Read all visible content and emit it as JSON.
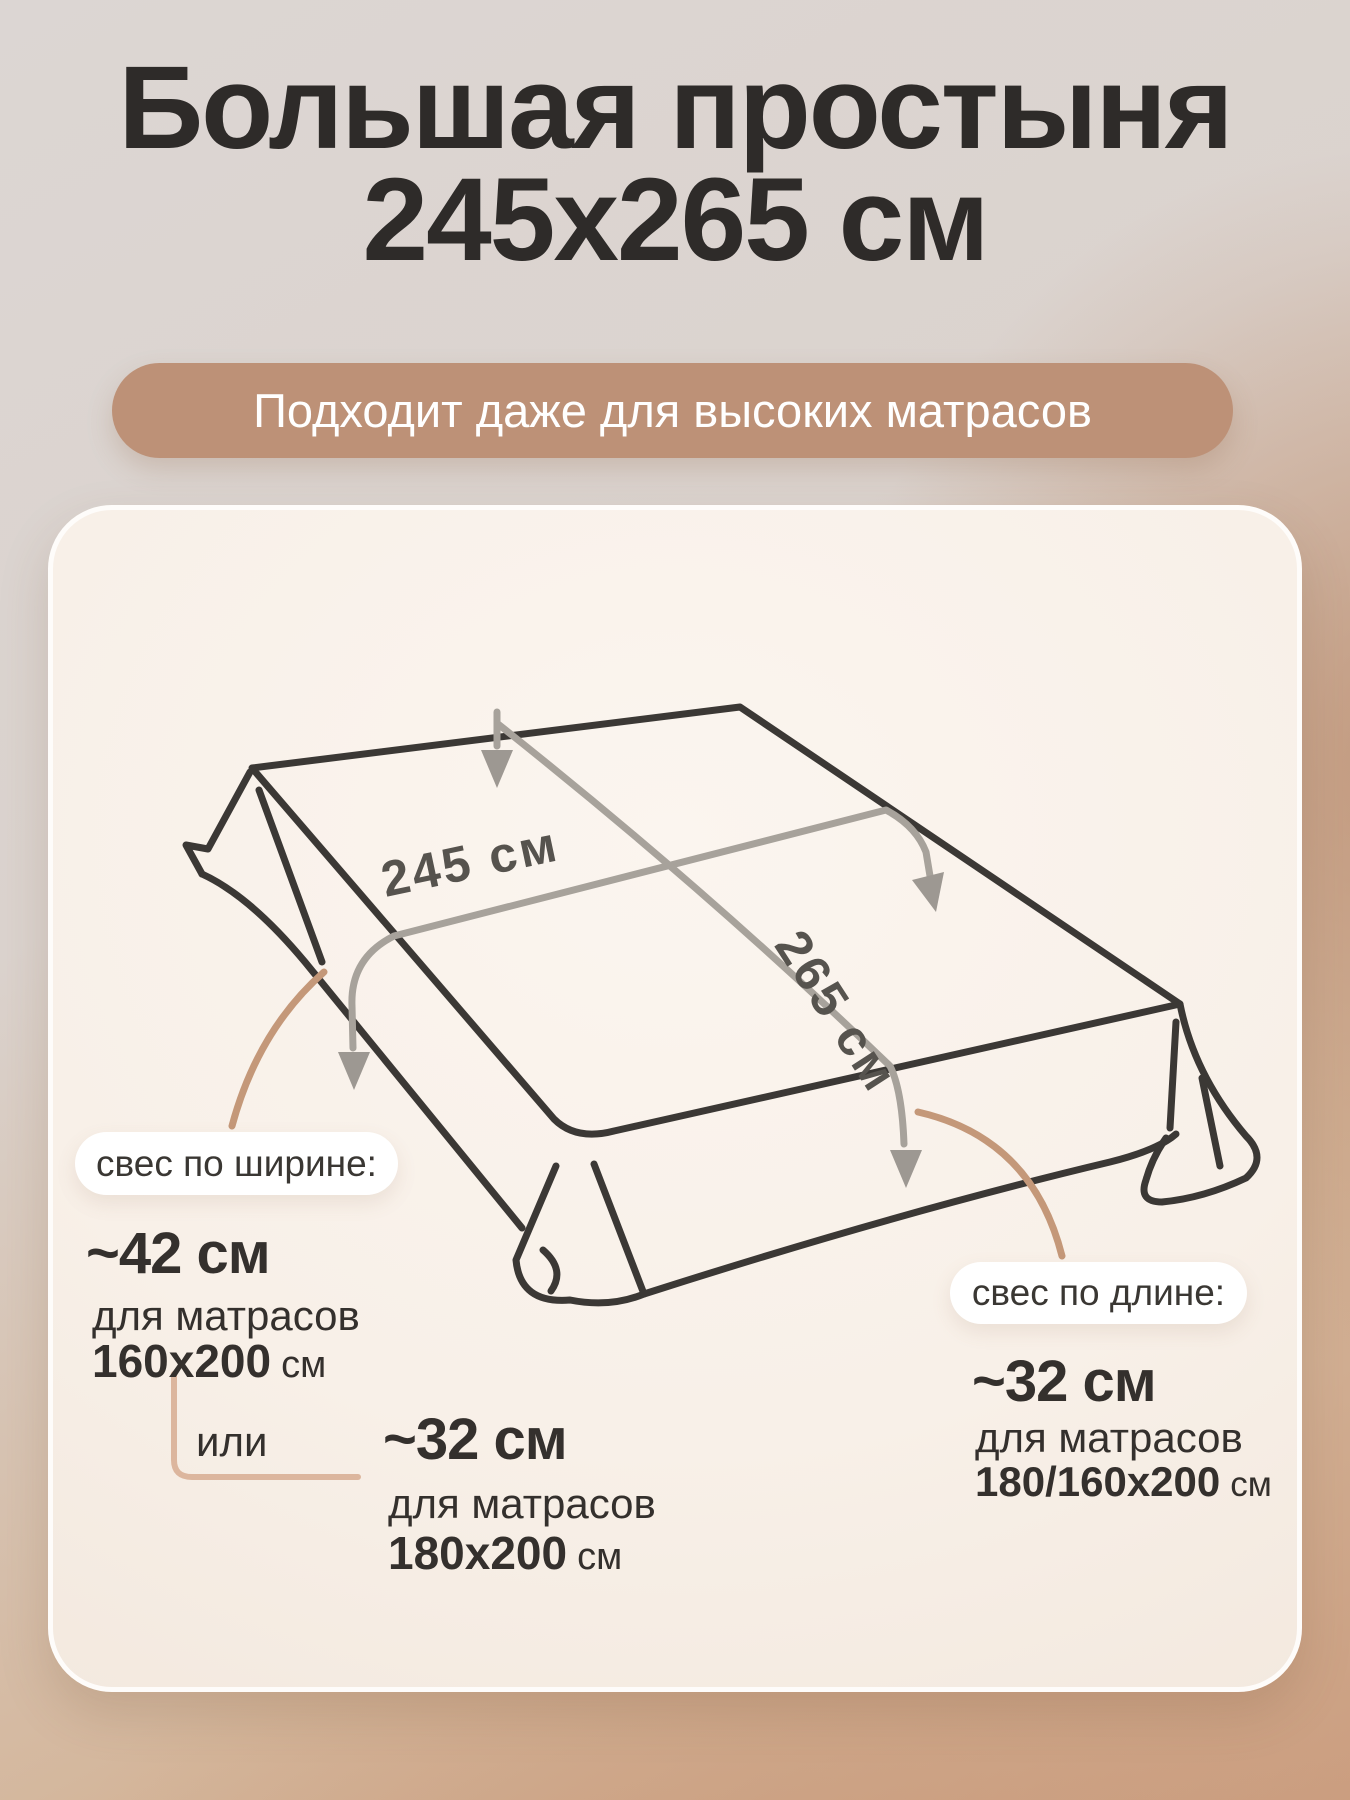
{
  "title": {
    "line1": "Большая простыня",
    "line2": "245х265 см"
  },
  "badge": {
    "label": "Подходит даже для высоких матрасов"
  },
  "sheet": {
    "width_label": "245 см",
    "length_label": "265 см"
  },
  "overhang_width": {
    "pill": "свес по ширине:",
    "option1": {
      "value": "~42 см",
      "for_text": "для матрасов",
      "size": "160х200",
      "unit": "см"
    },
    "or_text": "или",
    "option2": {
      "value": "~32 см",
      "for_text": "для матрасов",
      "size": "180х200",
      "unit": "см"
    }
  },
  "overhang_length": {
    "pill": "свес по длине:",
    "option": {
      "value": "~32 см",
      "for_text": "для матрасов",
      "size": "180/160х200",
      "unit": "см"
    }
  },
  "colors": {
    "badge_bg": "#bd9177",
    "card_bg": "#f8f0e8",
    "title_text": "#2e2b29",
    "sheet_line": "#3b3835",
    "measure_line": "#a7a29b",
    "accent_tan_line": "#c49879",
    "dim_text": "#56534e"
  }
}
